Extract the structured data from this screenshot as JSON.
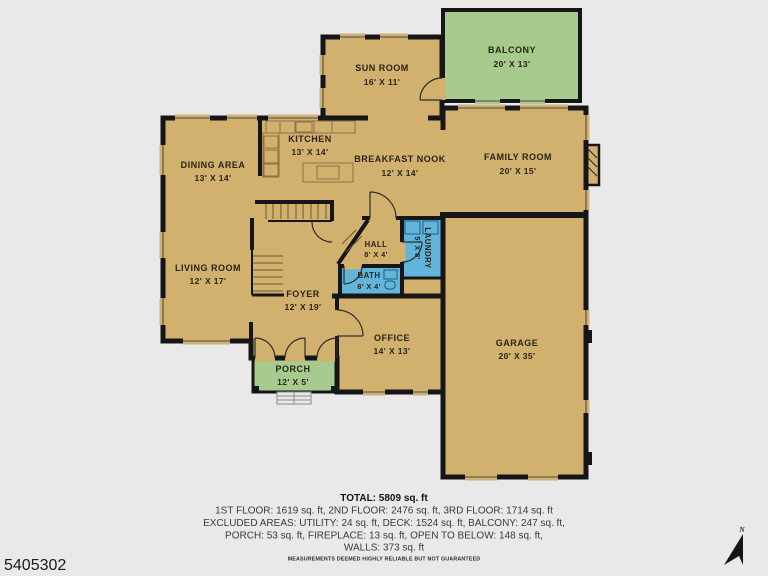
{
  "floor_plan": {
    "rooms": {
      "sun_room": {
        "name": "SUN ROOM",
        "dims": "16' X 11'"
      },
      "balcony": {
        "name": "BALCONY",
        "dims": "20' X 13'"
      },
      "kitchen": {
        "name": "KITCHEN",
        "dims": "13' X 14'"
      },
      "breakfast_nook": {
        "name": "BREAKFAST NOOK",
        "dims": "12' X 14'"
      },
      "family_room": {
        "name": "FAMILY ROOM",
        "dims": "20' X 15'"
      },
      "dining_area": {
        "name": "DINING AREA",
        "dims": "13' X 14'"
      },
      "living_room": {
        "name": "LIVING ROOM",
        "dims": "12' X 17'"
      },
      "hall": {
        "name": "HALL",
        "dims": "8' X 4'"
      },
      "laundry": {
        "name": "LAUNDRY",
        "dims": "5' X 8'"
      },
      "bath": {
        "name": "BATH",
        "dims": "8' X 4'"
      },
      "foyer": {
        "name": "FOYER",
        "dims": "12' X 19'"
      },
      "office": {
        "name": "OFFICE",
        "dims": "14' X 13'"
      },
      "garage": {
        "name": "GARAGE",
        "dims": "20' X 35'"
      },
      "porch": {
        "name": "PORCH",
        "dims": "12' X 5'"
      }
    },
    "colors": {
      "floor": "#d2b06e",
      "outdoor_green": "#a7cb8e",
      "wet_room_blue": "#62b4da",
      "walls": "#161616",
      "background": "#e9e9e9"
    }
  },
  "summary": {
    "total": "TOTAL: 5809 sq. ft",
    "floors": "1ST FLOOR: 1619 sq. ft, 2ND FLOOR: 2476 sq. ft, 3RD FLOOR: 1714 sq. ft",
    "excluded_1": "EXCLUDED AREAS: UTILITY: 24 sq. ft, DECK: 1524 sq. ft, BALCONY: 247 sq. ft,",
    "excluded_2": "PORCH: 53 sq. ft, FIREPLACE: 13 sq. ft, OPEN TO BELOW: 148 sq. ft,",
    "excluded_3": "WALLS: 373 sq. ft",
    "disclaimer": "MEASUREMENTS DEEMED HIGHLY RELIABLE BUT NOT GUARANTEED"
  },
  "listing_id": "5405302",
  "compass": {
    "label": "N"
  }
}
